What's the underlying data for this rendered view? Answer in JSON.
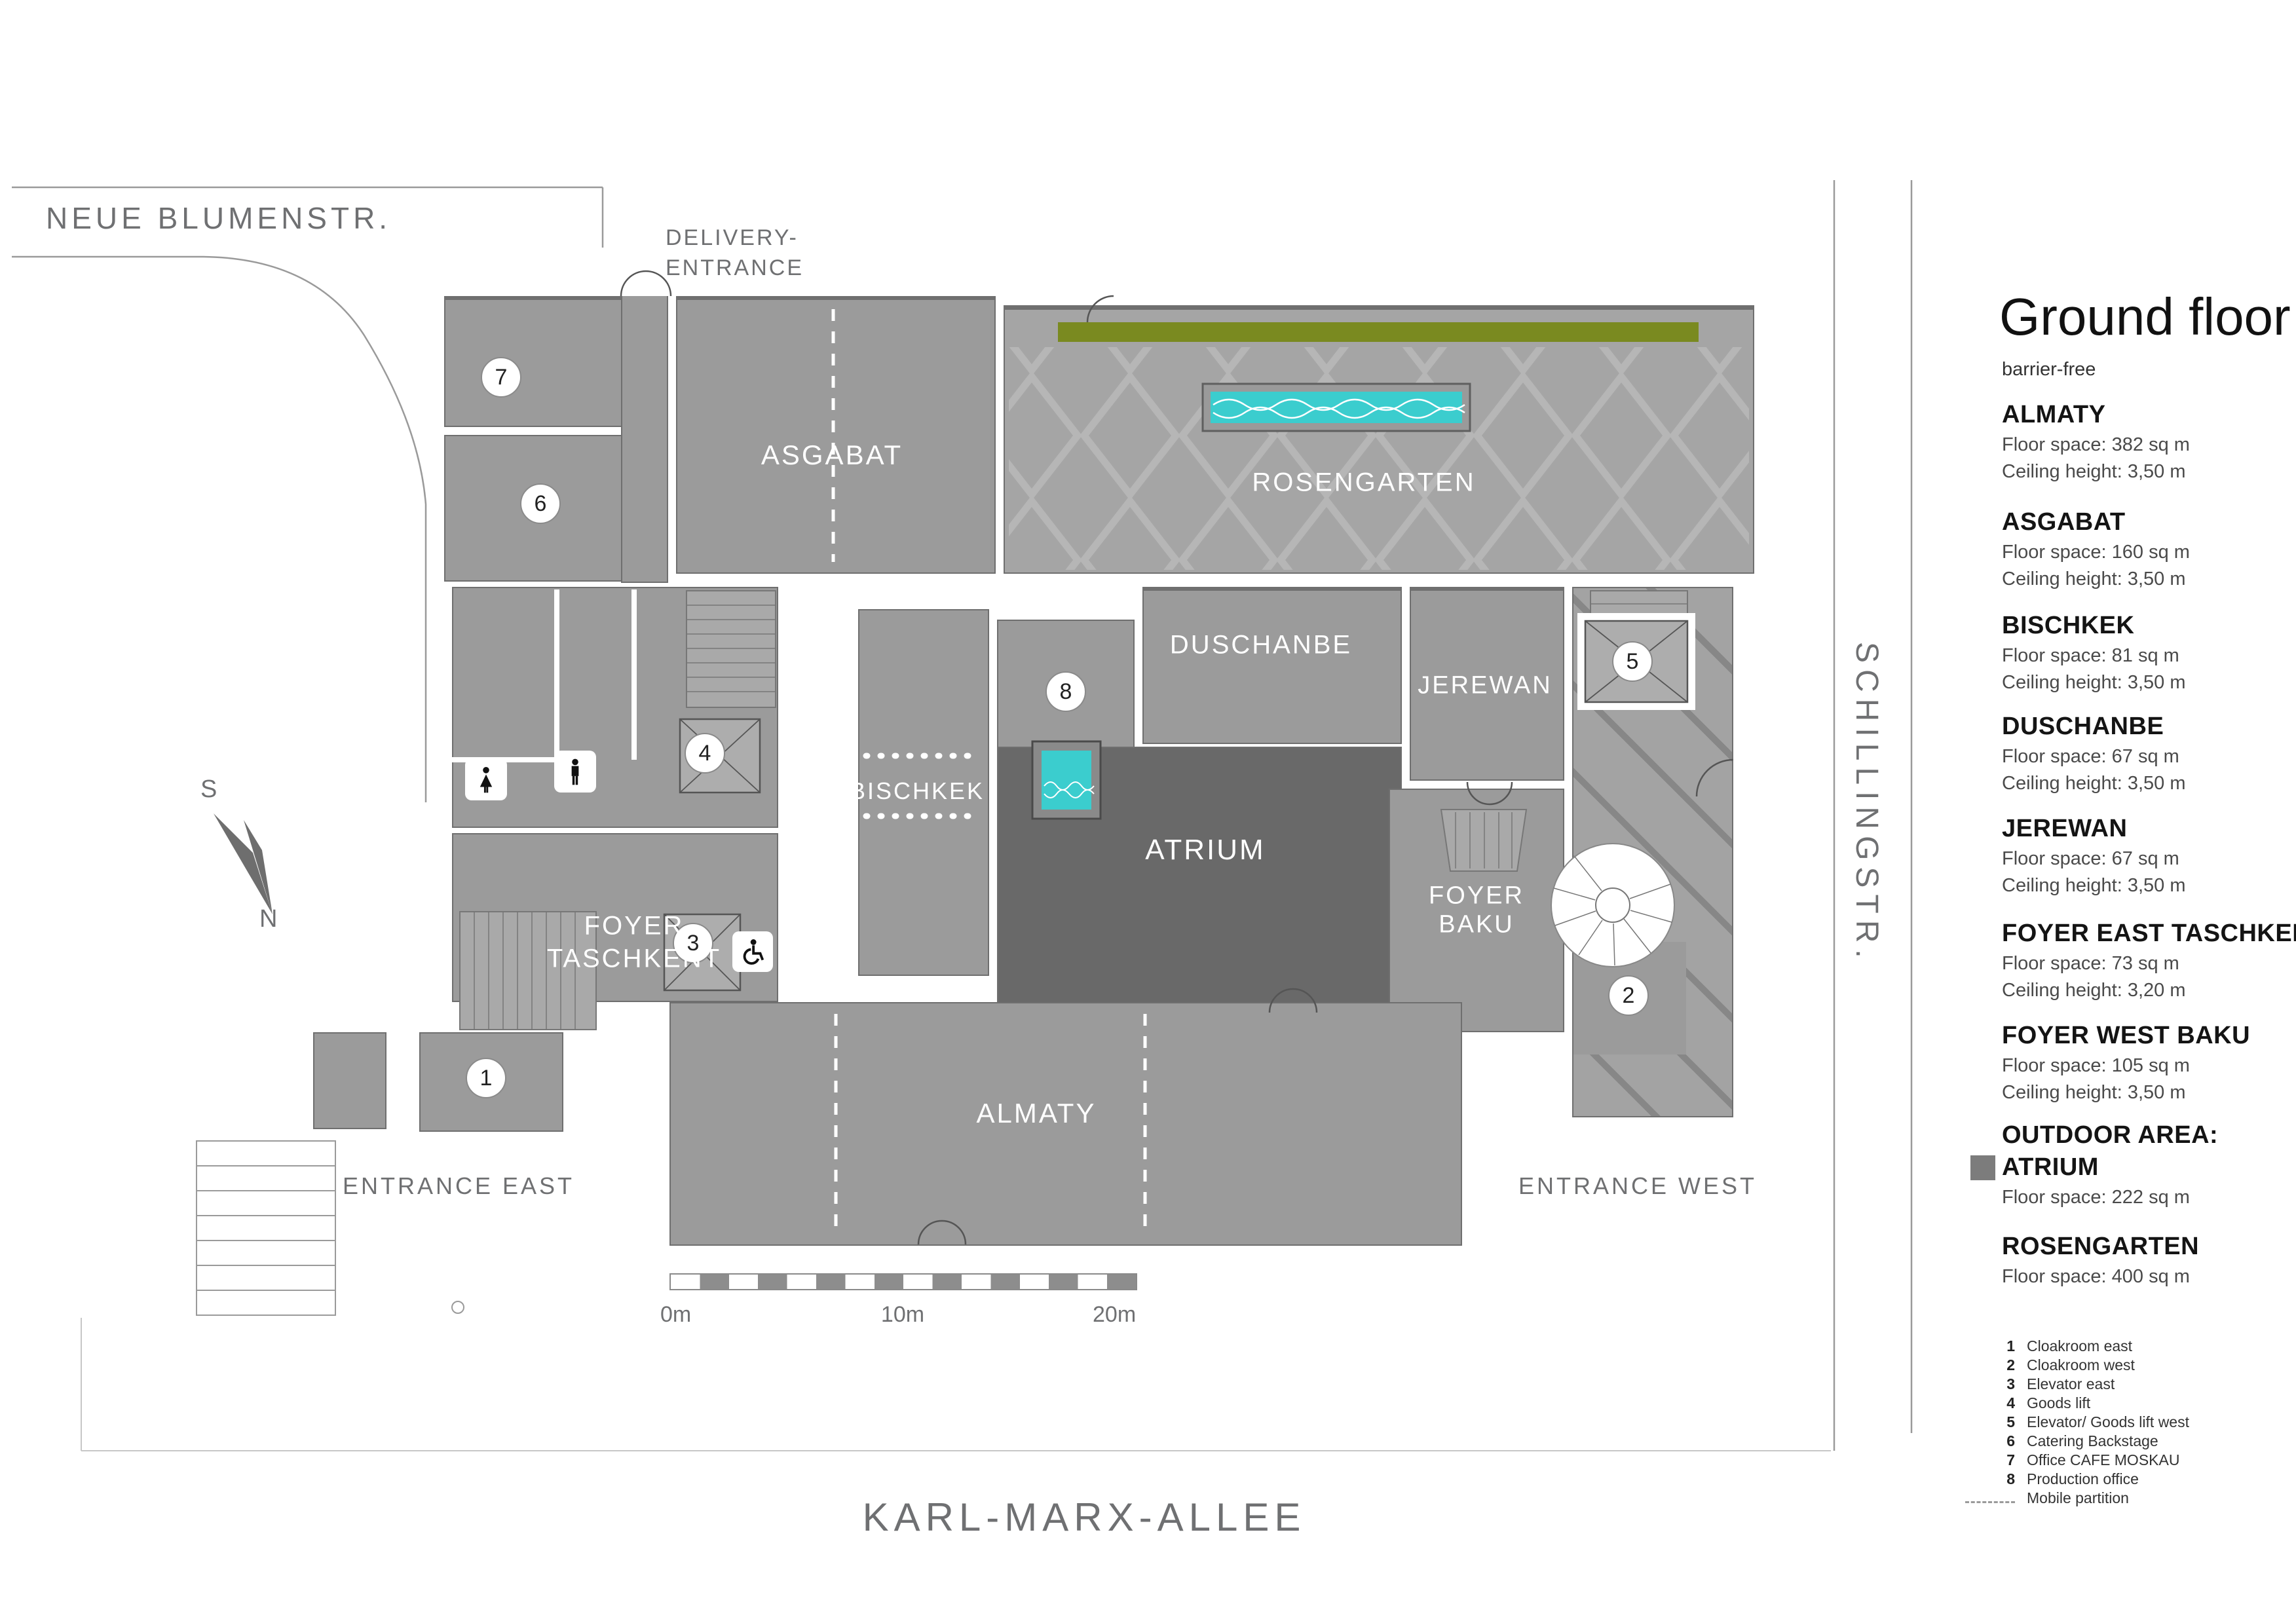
{
  "sidebar": {
    "title": "Ground floor",
    "subtitle": "barrier-free",
    "rooms": [
      {
        "name": "ALMATY",
        "floor": "Floor space: 382 sq m",
        "ceiling": "Ceiling height: 3,50 m"
      },
      {
        "name": "ASGABAT",
        "floor": "Floor space: 160 sq m",
        "ceiling": "Ceiling height: 3,50 m"
      },
      {
        "name": "BISCHKEK",
        "floor": "Floor space: 81 sq m",
        "ceiling": "Ceiling height: 3,50 m"
      },
      {
        "name": "DUSCHANBE",
        "floor": "Floor space: 67 sq m",
        "ceiling": "Ceiling height: 3,50 m"
      },
      {
        "name": "JEREWAN",
        "floor": "Floor space: 67 sq m",
        "ceiling": "Ceiling height: 3,50 m"
      },
      {
        "name": "FOYER EAST TASCHKENT",
        "floor": "Floor space: 73 sq m",
        "ceiling": "Ceiling height: 3,20 m"
      },
      {
        "name": "FOYER WEST BAKU",
        "floor": "Floor space: 105 sq m",
        "ceiling": "Ceiling height: 3,50 m"
      },
      {
        "name_line1": "OUTDOOR AREA:",
        "name_line2": "ATRIUM",
        "floor": "Floor space: 222 sq m"
      },
      {
        "name": "ROSENGARTEN",
        "floor": "Floor space: 400 sq m"
      }
    ],
    "legend": [
      {
        "num": "1",
        "label": "Cloakroom east"
      },
      {
        "num": "2",
        "label": "Cloakroom west"
      },
      {
        "num": "3",
        "label": "Elevator east"
      },
      {
        "num": "4",
        "label": "Goods lift"
      },
      {
        "num": "5",
        "label": "Elevator/ Goods lift west"
      },
      {
        "num": "6",
        "label": "Catering Backstage"
      },
      {
        "num": "7",
        "label": "Office CAFE MOSKAU"
      },
      {
        "num": "8",
        "label": "Production office"
      }
    ],
    "legend_partition_label": "Mobile partition"
  },
  "streets": {
    "north": "NEUE BLUMENSTR.",
    "east": "SCHILLINGSTR.",
    "south": "KARL-MARX-ALLEE"
  },
  "entrances": {
    "delivery_line1": "DELIVERY-",
    "delivery_line2": "ENTRANCE",
    "east": "ENTRANCE EAST",
    "west": "ENTRANCE WEST"
  },
  "plan_labels": {
    "asgabat": "ASGABAT",
    "rosengarten": "ROSENGARTEN",
    "duschanbe": "DUSCHANBE",
    "jerewan": "JEREWAN",
    "bischkek": "BISCHKEK",
    "atrium": "ATRIUM",
    "foyer_taschkent_1": "FOYER",
    "foyer_taschkent_2": "TASCHKENT",
    "foyer_baku_1": "FOYER",
    "foyer_baku_2": "BAKU",
    "almaty": "ALMATY"
  },
  "scale": {
    "m0": "0m",
    "m10": "10m",
    "m20": "20m"
  },
  "compass": {
    "s": "S",
    "n": "N"
  },
  "markers": [
    {
      "number": "1"
    },
    {
      "number": "2"
    },
    {
      "number": "3"
    },
    {
      "number": "4"
    },
    {
      "number": "5"
    },
    {
      "number": "6"
    },
    {
      "number": "7"
    },
    {
      "number": "8"
    }
  ],
  "colors": {
    "room_gray": "#9b9b9b",
    "atrium_gray": "#696969",
    "rosengarten_gray": "#a5a5a5",
    "accent_green": "#7a8a20",
    "pool_turquoise": "#3bcdce",
    "street_text": "#6f7072"
  }
}
